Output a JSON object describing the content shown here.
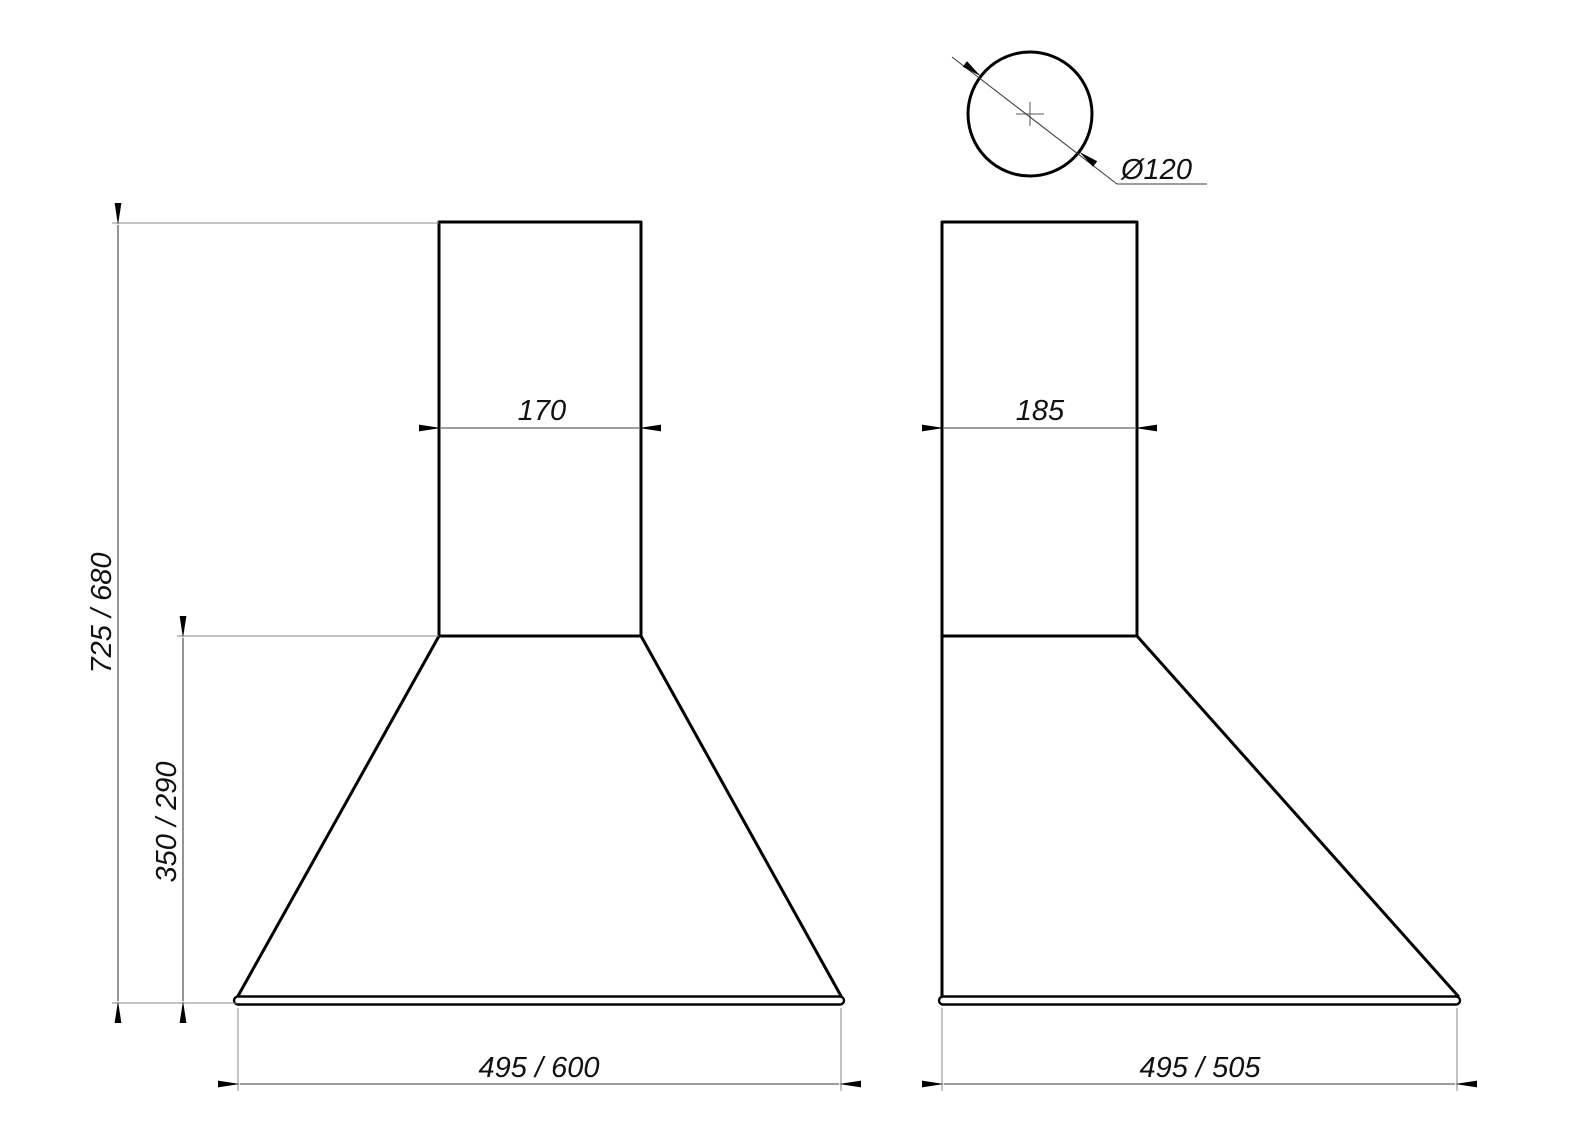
{
  "drawing": {
    "kind": "dimension-drawing",
    "line_color": "#000000",
    "thin_line_color": "#3d3d3d",
    "background_color": "#ffffff",
    "front_view": {
      "chimney_width": "170",
      "overall_height": "725 / 680",
      "hood_height": "350 / 290",
      "overall_width": "495 / 600"
    },
    "side_view": {
      "chimney_depth": "185",
      "overall_depth": "495 / 505"
    },
    "duct_outlet": {
      "diameter": "Ø120"
    }
  }
}
